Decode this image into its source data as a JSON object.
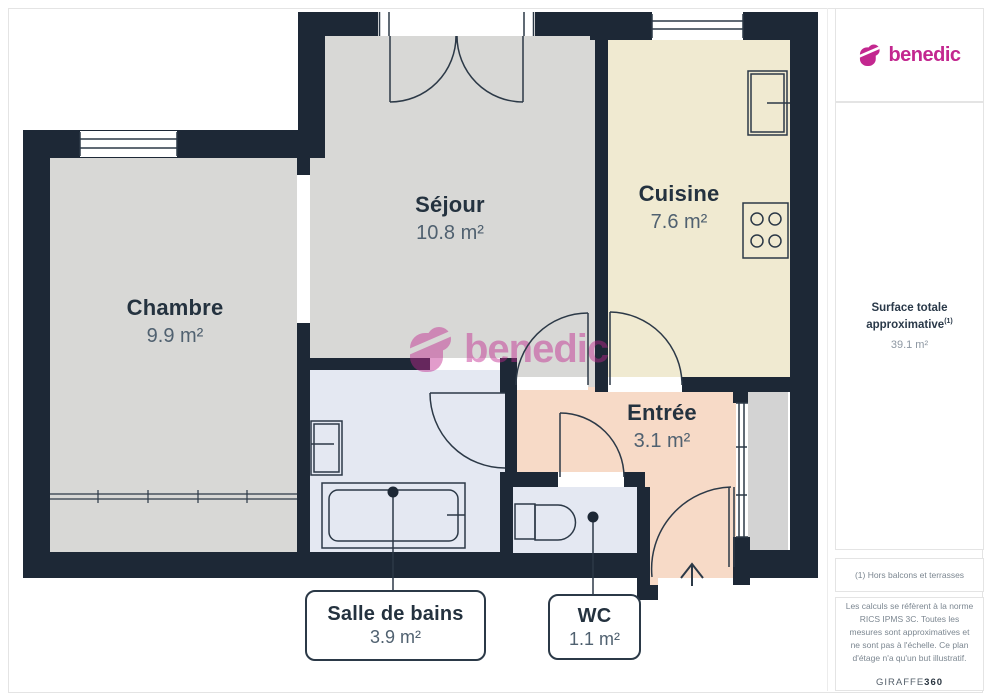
{
  "brand": {
    "name": "benedic",
    "color": "#c3278f"
  },
  "watermark": {
    "text": "benedic"
  },
  "plan": {
    "rooms": [
      {
        "id": "chambre",
        "name": "Chambre",
        "area": "9.9 m²"
      },
      {
        "id": "sejour",
        "name": "Séjour",
        "area": "10.8 m²"
      },
      {
        "id": "cuisine",
        "name": "Cuisine",
        "area": "7.6 m²"
      },
      {
        "id": "entree",
        "name": "Entrée",
        "area": "3.1 m²"
      },
      {
        "id": "salle-de-bains",
        "name": "Salle de bains",
        "area": "3.9 m²"
      },
      {
        "id": "wc",
        "name": "WC",
        "area": "1.1 m²"
      }
    ]
  },
  "sidebar": {
    "surface": {
      "label": "Surface totale approximative",
      "sup": "(1)",
      "value": "39.1 m²"
    },
    "footnote": "(1) Hors balcons et terrasses",
    "disclaimer": "Les calculs se réfèrent à la norme RICS IPMS 3C. Toutes les mesures sont approximatives et ne sont pas à l'échelle. Ce plan d'étage n'a qu'un but illustratif.",
    "provider": {
      "name": "GIRAFFE",
      "suffix": "360"
    }
  }
}
